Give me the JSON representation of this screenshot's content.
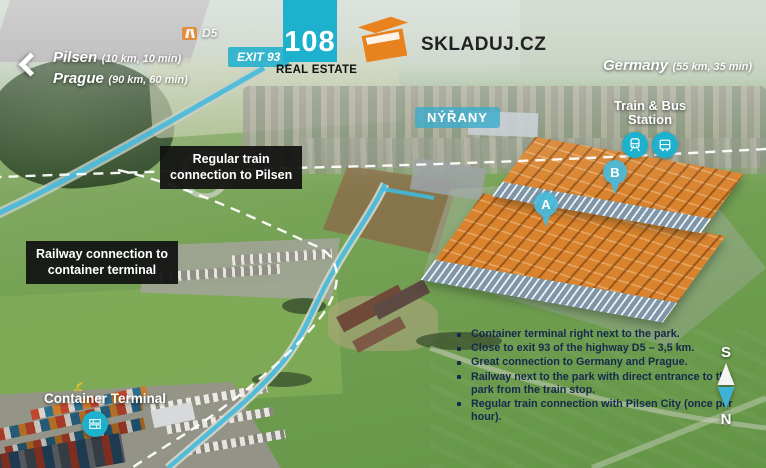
{
  "brand": {
    "logo_number": "108",
    "logo_subtitle": "REAL ESTATE",
    "skladuj_label": "SKLADUJ.CZ"
  },
  "directions": {
    "left": {
      "city1": "Pilsen",
      "detail1": "(10 km, 10 min)",
      "city2": "Prague",
      "detail2": "(90 km, 60 min)"
    },
    "right": {
      "city": "Germany",
      "detail": "(55 km, 35 min)"
    }
  },
  "road_signs": {
    "d5": "D5",
    "exit93": "EXIT 93"
  },
  "map_labels": {
    "town": "NÝŘANY",
    "station_line1": "Train & Bus",
    "station_line2": "Station",
    "regular_train_line1": "Regular train",
    "regular_train_line2": "connection to Pilsen",
    "railway_conn_line1": "Railway connection to",
    "railway_conn_line2": "container terminal",
    "container_terminal": "Container Terminal"
  },
  "markers": {
    "a": "A",
    "b": "B"
  },
  "features": [
    "Container terminal right next to the park.",
    "Close to exit 93 of the highway D5 – 3,5 km.",
    "Great connection to Germany and Prague.",
    "Railway next to the park with direct entrance to the park from the train stop.",
    "Regular train connection with Pilsen City (once per hour)."
  ],
  "compass": {
    "top": "S",
    "bottom": "N"
  },
  "colors": {
    "teal": "#1db1cd",
    "teal_route": "#41b9dc",
    "orange": "#e8821e",
    "label_bg": "#161616",
    "feature_text": "#16294e"
  }
}
